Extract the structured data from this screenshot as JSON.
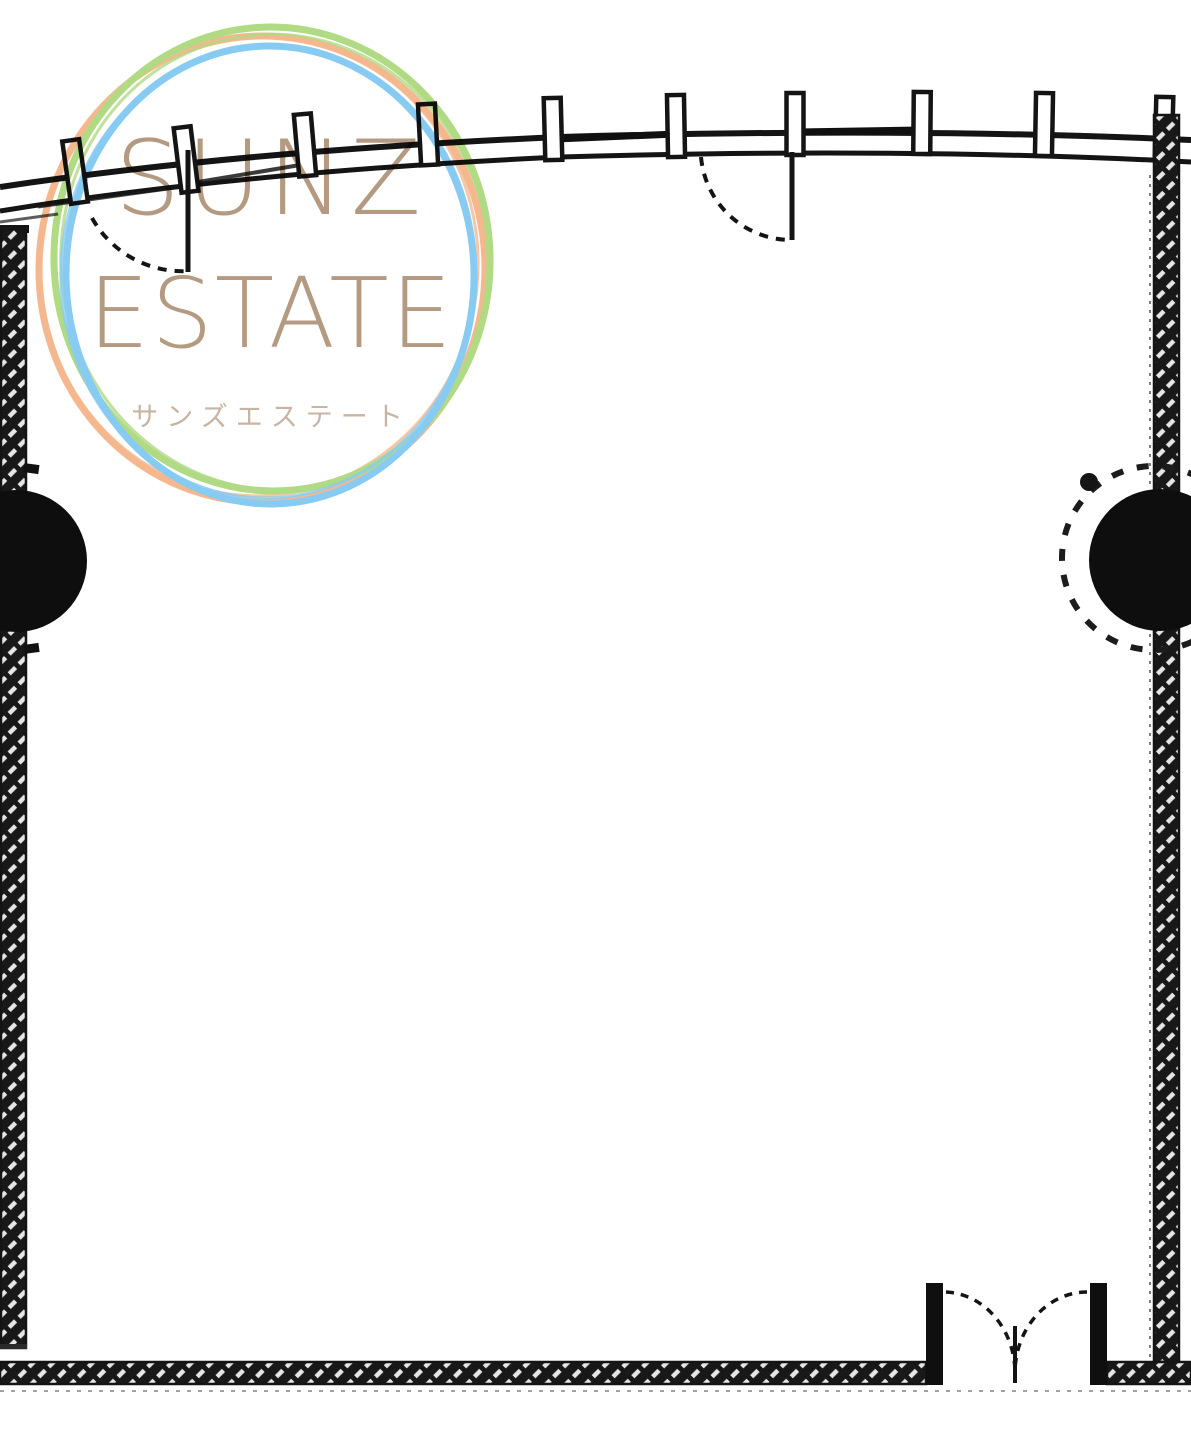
{
  "logo": {
    "line1": "SUNZ",
    "line2": "ESTATE",
    "subtitle": "サンズエステート",
    "text_color": "#b49a81",
    "subtitle_color": "#c8b4a2",
    "ring_colors": {
      "orange": "#f5b88e",
      "green": "#b0da83",
      "blue": "#87cbf2"
    }
  },
  "floorplan": {
    "ink_color": "#141414",
    "wall_hatch_light": "#e8e8e8",
    "background": "#ffffff"
  }
}
